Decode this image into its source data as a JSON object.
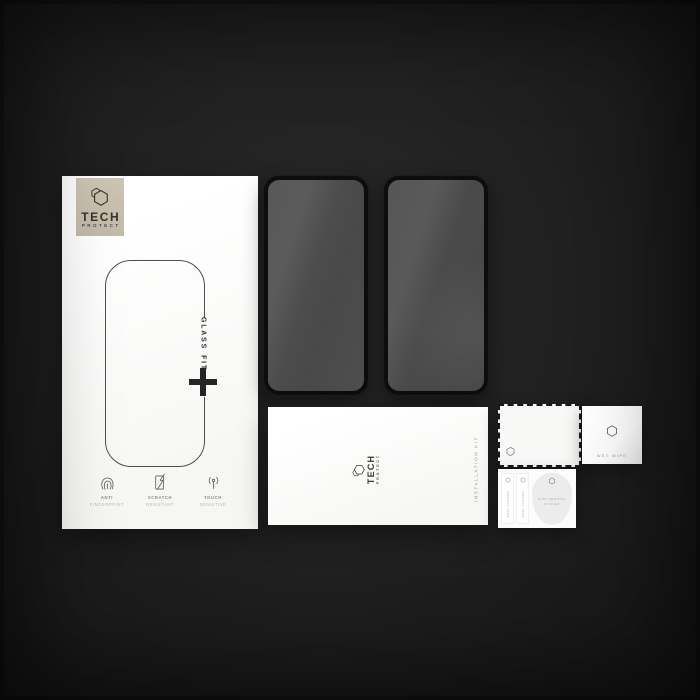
{
  "colors": {
    "background": "#1f1f1f",
    "box_white": "#fbfbfa",
    "logo_square_beige": "#c9c0ae",
    "glass_frame": "#0d0d0d",
    "glass_surface": "#4a4a4a",
    "brand_text": "#34332e",
    "muted_text": "#9b9b9b"
  },
  "retail_box": {
    "brand": {
      "line1": "TECH",
      "line2": "PROTECT"
    },
    "glass_fit": {
      "word1": "GLASS",
      "word2": "FIT"
    },
    "plus_icon": "+",
    "features": [
      {
        "icon": "fingerprint-icon",
        "line1": "ANTI",
        "line2": "FINGERPRINT"
      },
      {
        "icon": "scratch-icon",
        "line1": "SCRATCH",
        "line2": "RESISTANT"
      },
      {
        "icon": "touch-icon",
        "line1": "TOUCH",
        "line2": "SENSITIVE"
      }
    ]
  },
  "glass_panels": {
    "count": 2
  },
  "installation_kit": {
    "brand": {
      "line1": "TECH",
      "line2": "PROTECT"
    },
    "side_label": "INSTALLATION KIT"
  },
  "wet_wipe": {
    "label": "WET WIPE"
  },
  "sticker_card": {
    "strips": [
      {
        "label": "EASY STICKER"
      },
      {
        "label": "EASY STICKER"
      }
    ],
    "blob": {
      "line1": "DUST REMOVAL",
      "line2": "STICKER"
    }
  },
  "icons": {
    "brand_logo": "hexagon-logo-icon",
    "small_marks": "hexagon-icon"
  }
}
